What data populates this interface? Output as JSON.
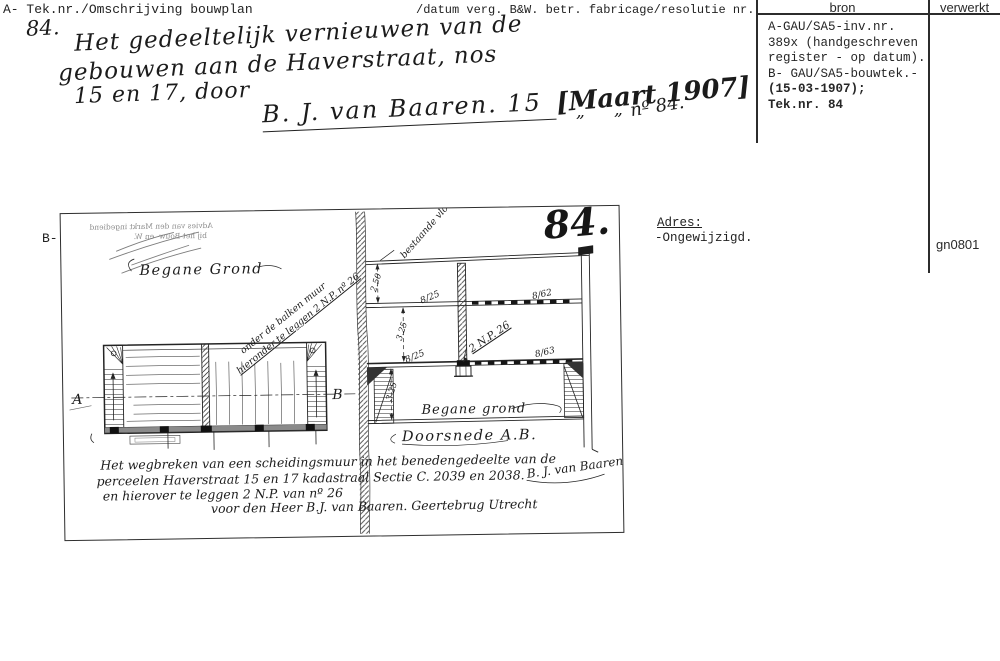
{
  "page": {
    "header_left": "A- Tek.nr./Omschrijving bouwplan",
    "header_middle": "/datum verg. B&W. betr. fabricage/resolutie nr.",
    "side_label": "B-",
    "code": "gn0801"
  },
  "register": {
    "bron_label": "bron",
    "verwerkt_label": "verwerkt",
    "bron_lines": [
      "A-GAU/SA5-inv.nr.",
      "389x (handgeschreven",
      "register - op datum).",
      "B- GAU/SA5-bouwtek.-",
      "(15-03-1907);",
      "Tek.nr. 84"
    ]
  },
  "adres": {
    "label": "Adres:",
    "value": "-Ongewijzigd."
  },
  "description": {
    "number": "84.",
    "line1": "Het gedeeltelijk vernieuwen van de",
    "line2": "gebouwen aan de Haverstraat, nos",
    "line3": "15 en 17, door",
    "applicant": "B. J. van Baaren. 15",
    "date": "[Maart 1907]",
    "ditto": "„",
    "number_note": "nº 84."
  },
  "drawing": {
    "sheet_number": "84.",
    "stamp_line1": "Advies van den Markt ingediend",
    "stamp_line2": "bij het Bouw- en W.",
    "plan": {
      "title": "Begane Grond",
      "annotation_line1": "onder de balken muur",
      "annotation_line2": "hieronder te leggen 2 N.P. nº 26",
      "marker_a": "A",
      "marker_b": "B"
    },
    "section": {
      "caption": "Doorsnede A.B.",
      "floor_label": "Begane grond",
      "top_label": "bestaande vloer",
      "dim_top": "2.50",
      "dim_mid": "3.25",
      "dim_bottom": "3.25",
      "beam_label_1": "8/25",
      "beam_label_2": "8/62",
      "beam_label_3": "8/25",
      "beam_label_4": "8/63",
      "np_label": "2 N.P. 26"
    },
    "note_line1": "Het wegbreken van een scheidingsmuur in het benedengedeelte van de",
    "note_line2": "perceelen Haverstraat 15 en 17 kadastraal Sectie C. 2039 en 2038.",
    "note_line3": "en hierover te leggen 2 N.P. van nº 26",
    "note_line4": "voor den Heer B.J. van Baaren. Geertebrug Utrecht",
    "signature": "B. J. van Baaren"
  }
}
